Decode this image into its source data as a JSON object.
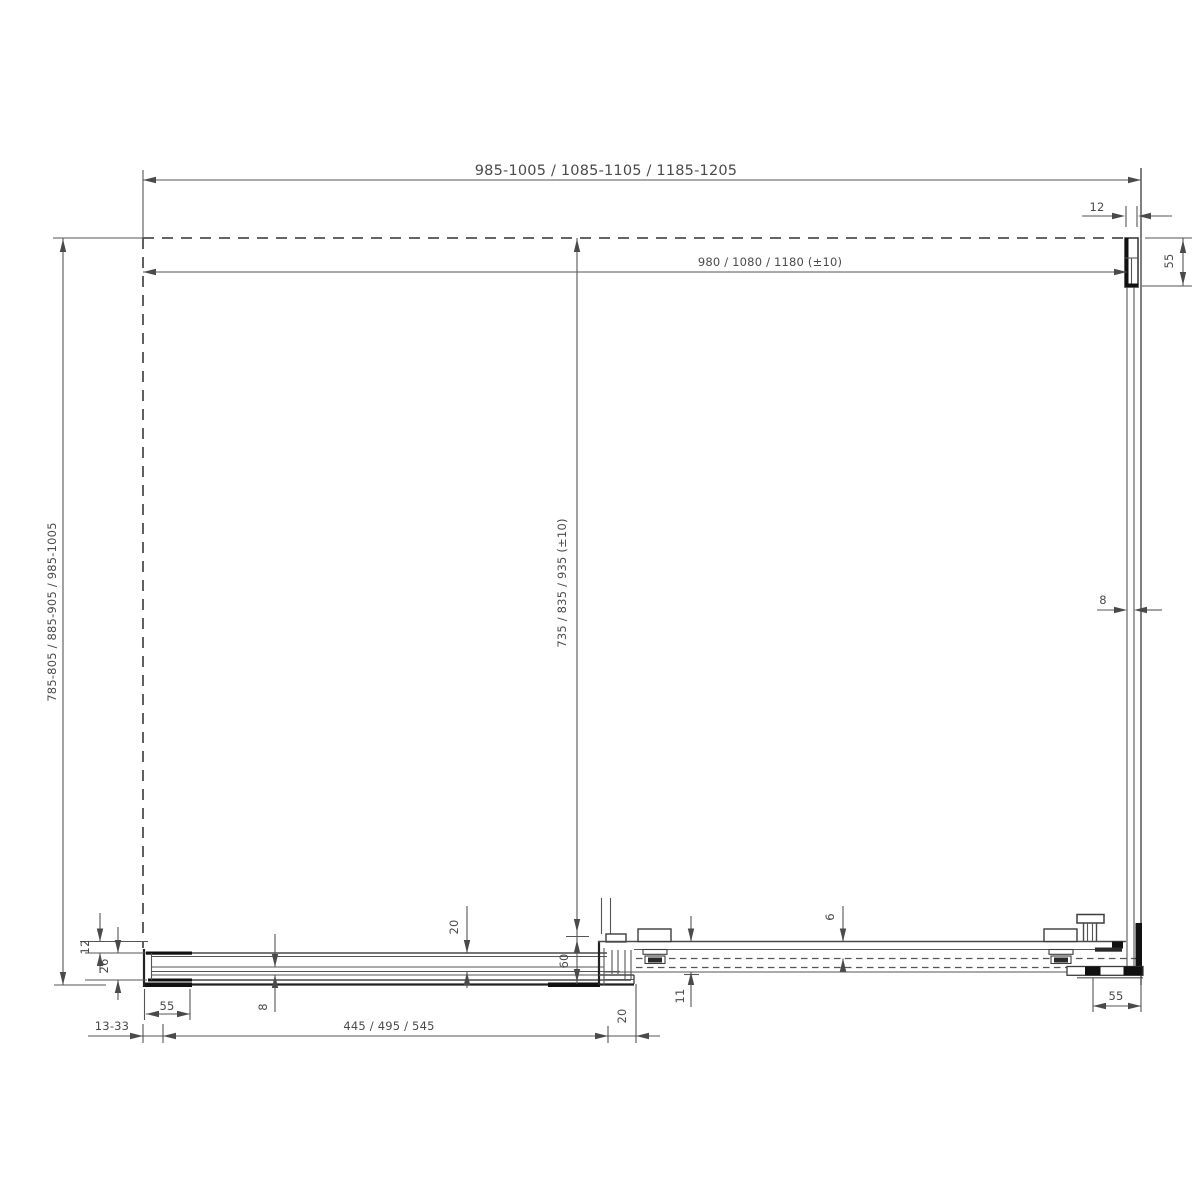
{
  "drawing_type": "shower-enclosure-technical-dimension-drawing",
  "labels": {
    "width_overall": "985-1005 / 1085-1105 / 1185-1205",
    "width_glass": "980 / 1080 / 1180 (±10)",
    "depth_overall": "785-805 / 885-905 / 985-1005",
    "depth_glass": "735 / 835 / 935 (±10)",
    "top_profile_width": "12",
    "top_bracket_height": "55",
    "right_glass_thickness": "8",
    "left_offset": "12",
    "left_profile_height": "26",
    "left_bracket_width": "55",
    "wall_adjustment": "13-33",
    "bottom_glass_thickness": "8",
    "fixed_part_width": "445 / 495 / 545",
    "profile_depth": "20",
    "rail_height": "60",
    "door_overlap": "20",
    "rail_bottom_height": "11",
    "rail_top_gap": "6",
    "corner_bracket_width": "55"
  },
  "colors": {
    "line": "#555555",
    "dark_fill": "#111111",
    "text": "#4a4a4a",
    "background": "#ffffff"
  }
}
